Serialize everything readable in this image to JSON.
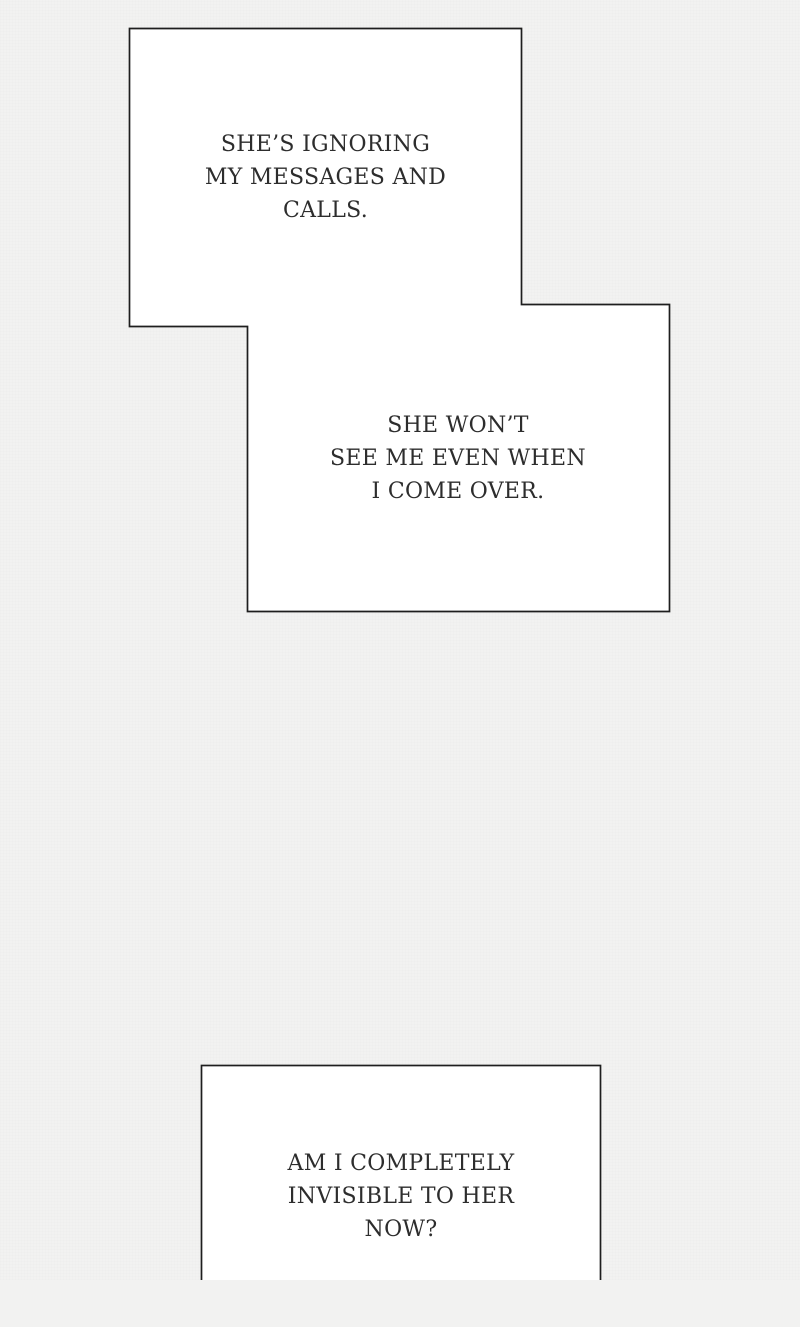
{
  "page": {
    "kind": "webtoon-comic-page"
  },
  "theme": {
    "page_bg": "#f2f2f1",
    "panel_fill": "#ffffff",
    "panel_border": "#1e1e1e",
    "text_color": "#2d2d2d"
  },
  "panels": [
    {
      "id": "narration-box-1",
      "lines": [
        "SHE’S IGNORING",
        "MY MESSAGES AND",
        "CALLS."
      ]
    },
    {
      "id": "narration-box-2",
      "lines": [
        "SHE WON’T",
        "SEE ME EVEN WHEN",
        "I COME OVER."
      ]
    },
    {
      "id": "narration-box-3",
      "lines": [
        "AM I COMPLETELY",
        "INVISIBLE TO HER",
        "NOW?"
      ]
    }
  ]
}
